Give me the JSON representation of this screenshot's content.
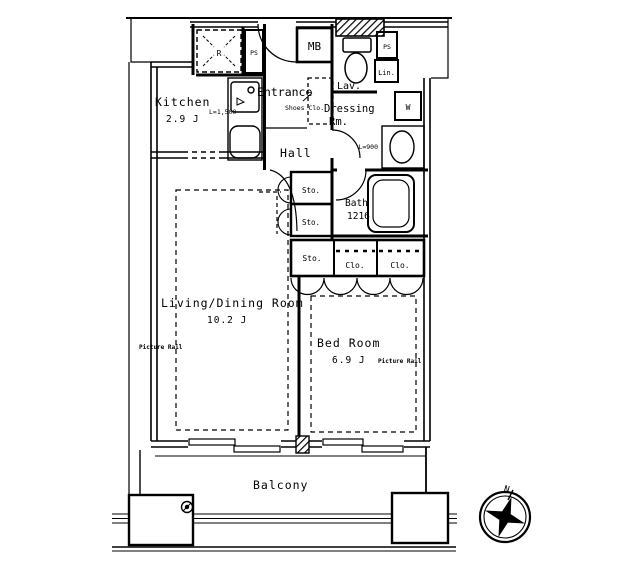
{
  "rooms": {
    "kitchen": {
      "name": "Kitchen",
      "area": "2.9 J"
    },
    "entrance": {
      "name": "Entrance"
    },
    "hall": {
      "name": "Hall"
    },
    "lavatory": {
      "name": "Lav."
    },
    "dressing_room": {
      "line1": "Dressing",
      "line2": "Rm."
    },
    "bath": {
      "name": "Bath",
      "size": "1216"
    },
    "living_dining": {
      "name": "Living/Dining Room",
      "area": "10.2 J"
    },
    "bedroom": {
      "name": "Bed Room",
      "area": "6.9 J"
    },
    "balcony": {
      "name": "Balcony"
    }
  },
  "fixtures": {
    "meter_box": "MB",
    "refrigerator_space": "R",
    "pipe_space_kitchen": "PS",
    "pipe_space_lavatory": "PS",
    "linen_closet": "Lin.",
    "washing_machine": "W",
    "shoes_closet": "Shoes Clo.",
    "hall_storage_upper": "Sto.",
    "hall_storage_lower": "Sto.",
    "closet_row_storage": "Sto.",
    "closet_row_closet_1": "Clo.",
    "closet_row_closet_2": "Clo.",
    "kitchen_counter_length": "L=1,500",
    "washbasin_length": "L=900"
  },
  "annotations": {
    "picture_rail_living": "Picture Rail",
    "picture_rail_bedroom": "Picture Rail",
    "north": "N"
  },
  "colors": {
    "line": "#000000",
    "background": "#ffffff"
  }
}
